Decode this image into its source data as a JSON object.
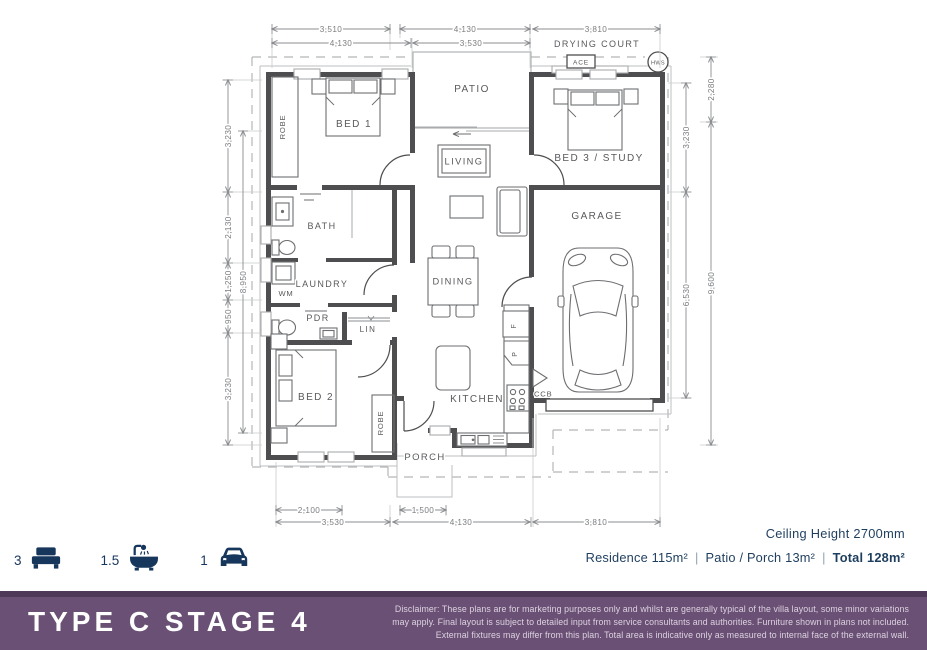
{
  "plan": {
    "rooms": {
      "bed1": "BED 1",
      "bed2": "BED 2",
      "bed3_study": "BED 3 / STUDY",
      "patio": "PATIO",
      "living": "LIVING",
      "dining": "DINING",
      "kitchen": "KITCHEN",
      "garage": "GARAGE",
      "bath": "BATH",
      "laundry": "LAUNDRY",
      "pdr": "PDR",
      "lin": "LIN",
      "porch": "PORCH",
      "robe1": "ROBE",
      "robe2": "ROBE",
      "wm": "WM",
      "ccb": "CCB",
      "fridge": "F",
      "pantry": "P",
      "drying_court": "DRYING COURT",
      "ace": "ACE",
      "hws": "HWS"
    },
    "dimensions": {
      "top_row1": [
        "3,510",
        "4,130",
        "3,810"
      ],
      "top_row2": [
        "4,130",
        "3,530"
      ],
      "bottom_row1": [
        "2,100",
        "1,500"
      ],
      "bottom_row2": [
        "3,530",
        "4,130",
        "3,810"
      ],
      "left_outer": [
        "3,230",
        "2,130",
        "1,250",
        "950",
        "3,230"
      ],
      "left_inner": [
        "8,950"
      ],
      "right_inner": [
        "3,230",
        "6,530"
      ],
      "right_outer": [
        "2,280",
        "9,600"
      ]
    }
  },
  "summary": {
    "beds": "3",
    "baths": "1.5",
    "cars": "1",
    "ceiling": "Ceiling Height 2700mm",
    "residence": "Residence 115m²",
    "patio_porch": "Patio / Porch 13m²",
    "total": "Total 128m²",
    "separator": "|"
  },
  "footer": {
    "title": "TYPE C STAGE 4",
    "disclaimer_line1": "Disclaimer: These plans are for marketing purposes only and whilst are generally typical of the villa layout, some minor variations",
    "disclaimer_line2": "may apply. Final layout is subject to detailed input from service consultants and authorities. Furniture shown in plans not included.",
    "disclaimer_line3": "External fixtures may differ from this plan. Total area is indicative only as measured to internal face of the external wall."
  },
  "colors": {
    "accent_purple": "#6a5074",
    "accent_purple_dark": "#4e3a58",
    "navy": "#17365c",
    "wall": "#4e4e50"
  }
}
